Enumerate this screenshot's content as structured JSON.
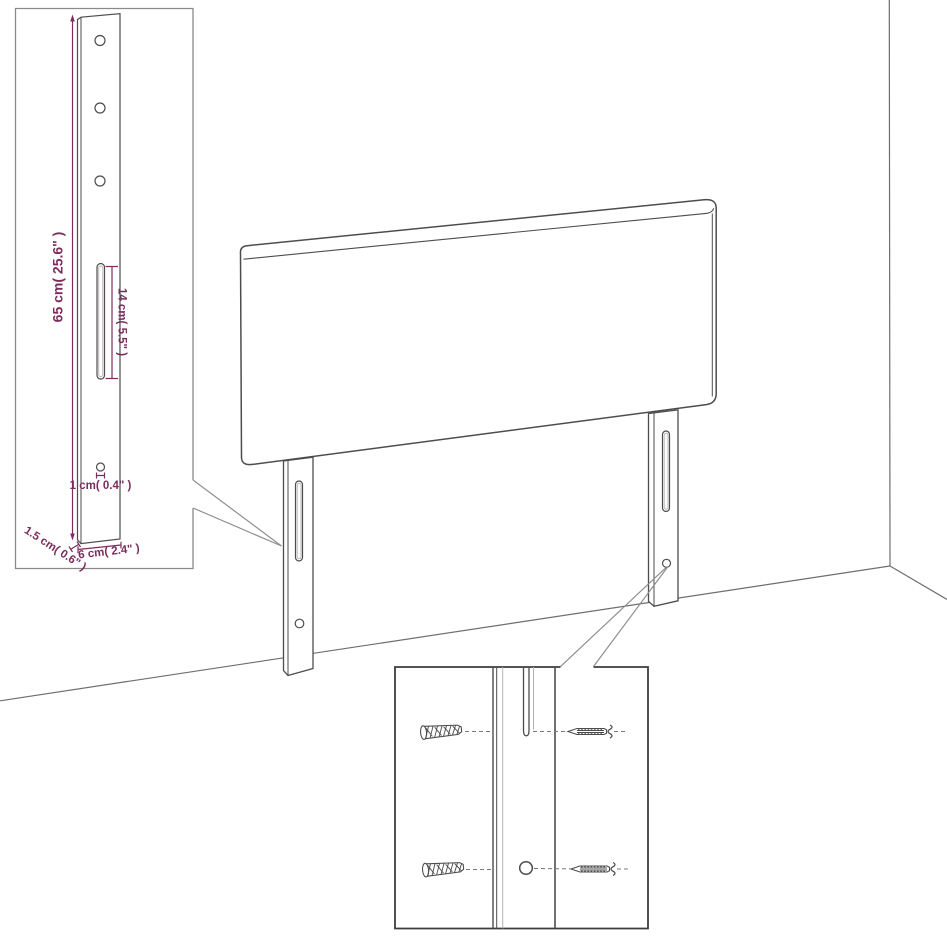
{
  "figure": {
    "type": "furniture-assembly-diagram",
    "subject": "upholstered headboard with two wall-mount bracket legs shown in a room corner",
    "insets": [
      "leg-bracket-dimension-detail",
      "fastener-mounting-detail"
    ]
  },
  "colors": {
    "accent_dimension": "#7c2d5e",
    "outline": "#4d4d4d",
    "inset_border_light": "#8a8a8a",
    "inset_border_dark": "#3d3d3d",
    "background": "#ffffff"
  },
  "inset_leg_detail": {
    "height_label": "65 cm( 25.6\" )",
    "slot_label": "14 cm( 5.5\" )",
    "hole_label": "1 cm( 0.4\" )",
    "thickness_label": "1.5 cm( 0.6\" )",
    "width_label": "6 cm( 2.4\" )"
  }
}
